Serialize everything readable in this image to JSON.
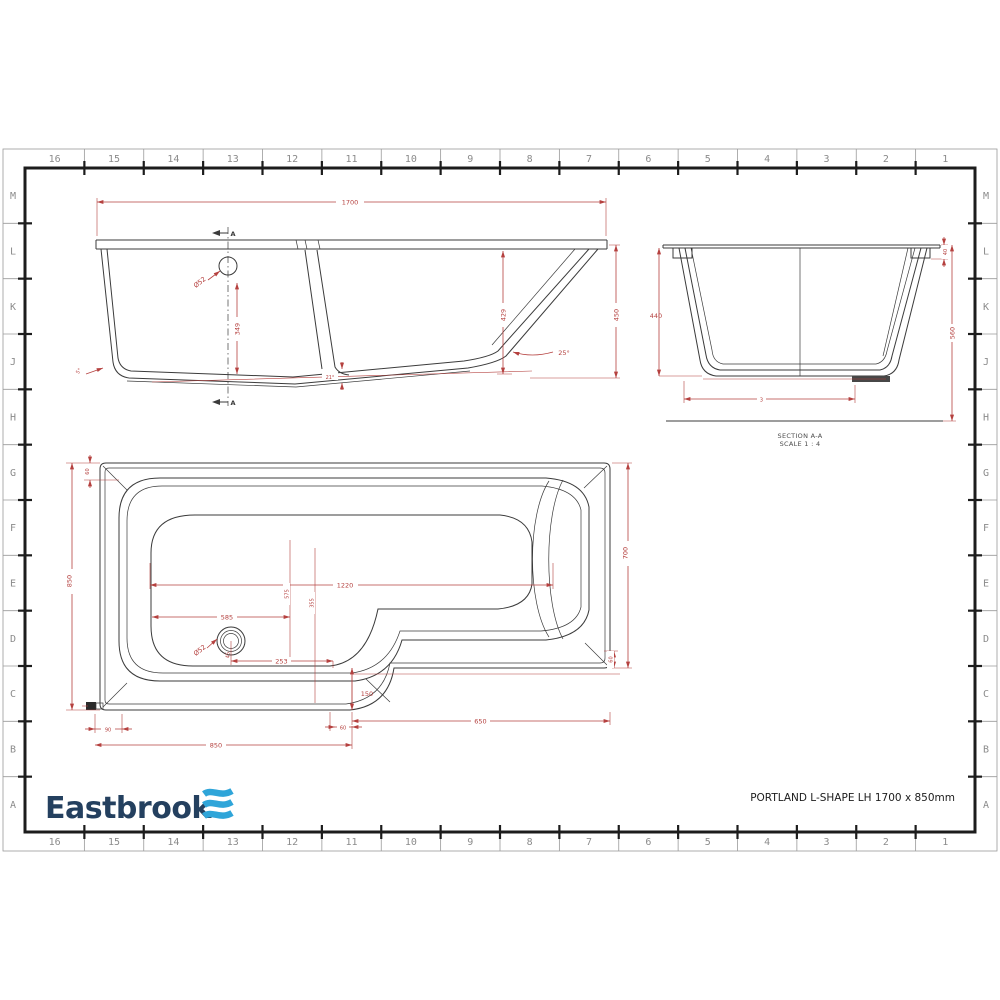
{
  "colors": {
    "dim_red": "#b5413f",
    "line_black": "#3b3b3b",
    "brand_navy": "#24405f",
    "brand_blue": "#2fa5d9",
    "grid_gray": "#8b8b8b"
  },
  "grid": {
    "columns": [
      "16",
      "15",
      "14",
      "13",
      "12",
      "11",
      "10",
      "9",
      "8",
      "7",
      "6",
      "5",
      "4",
      "3",
      "2",
      "1"
    ],
    "rows": [
      "M",
      "L",
      "K",
      "J",
      "H",
      "G",
      "F",
      "E",
      "D",
      "C",
      "B",
      "A"
    ]
  },
  "side_view": {
    "section_marker_top": "A",
    "section_marker_bottom": "A",
    "dims": {
      "overall_length": "1700",
      "waste_diameter": "Ø52",
      "waste_height": "349",
      "inner_depth": "429",
      "overall_height": "450",
      "end_slope_angle": "25°",
      "front_slope_angle": "5°",
      "bottom_slope_angle": "21°"
    }
  },
  "section_view": {
    "label_line1": "SECTION A-A",
    "label_line2": "SCALE 1 : 4",
    "dims": {
      "inner_depth": "440",
      "rim_height": "40",
      "overall_height": "560",
      "bottom_width": "3"
    }
  },
  "plan_view": {
    "dims": {
      "rim_width_top": "60",
      "overall_width": "850",
      "inner_length": "1220",
      "waste_from_top": "575",
      "seat_depth": "355",
      "waste_from_left": "585",
      "waste_diameter": "Ø52",
      "waste_offset": "45",
      "waste_to_step": "253",
      "step_height": "150",
      "narrow_length": "650",
      "rim_width_bottom_left": "90",
      "wide_length": "850",
      "step_width": "60",
      "rim_width_right": "60",
      "narrow_width": "700"
    }
  },
  "footer": {
    "brand": "Eastbrook",
    "drawing_title": "PORTLAND  L-SHAPE  LH 1700 x 850mm"
  }
}
